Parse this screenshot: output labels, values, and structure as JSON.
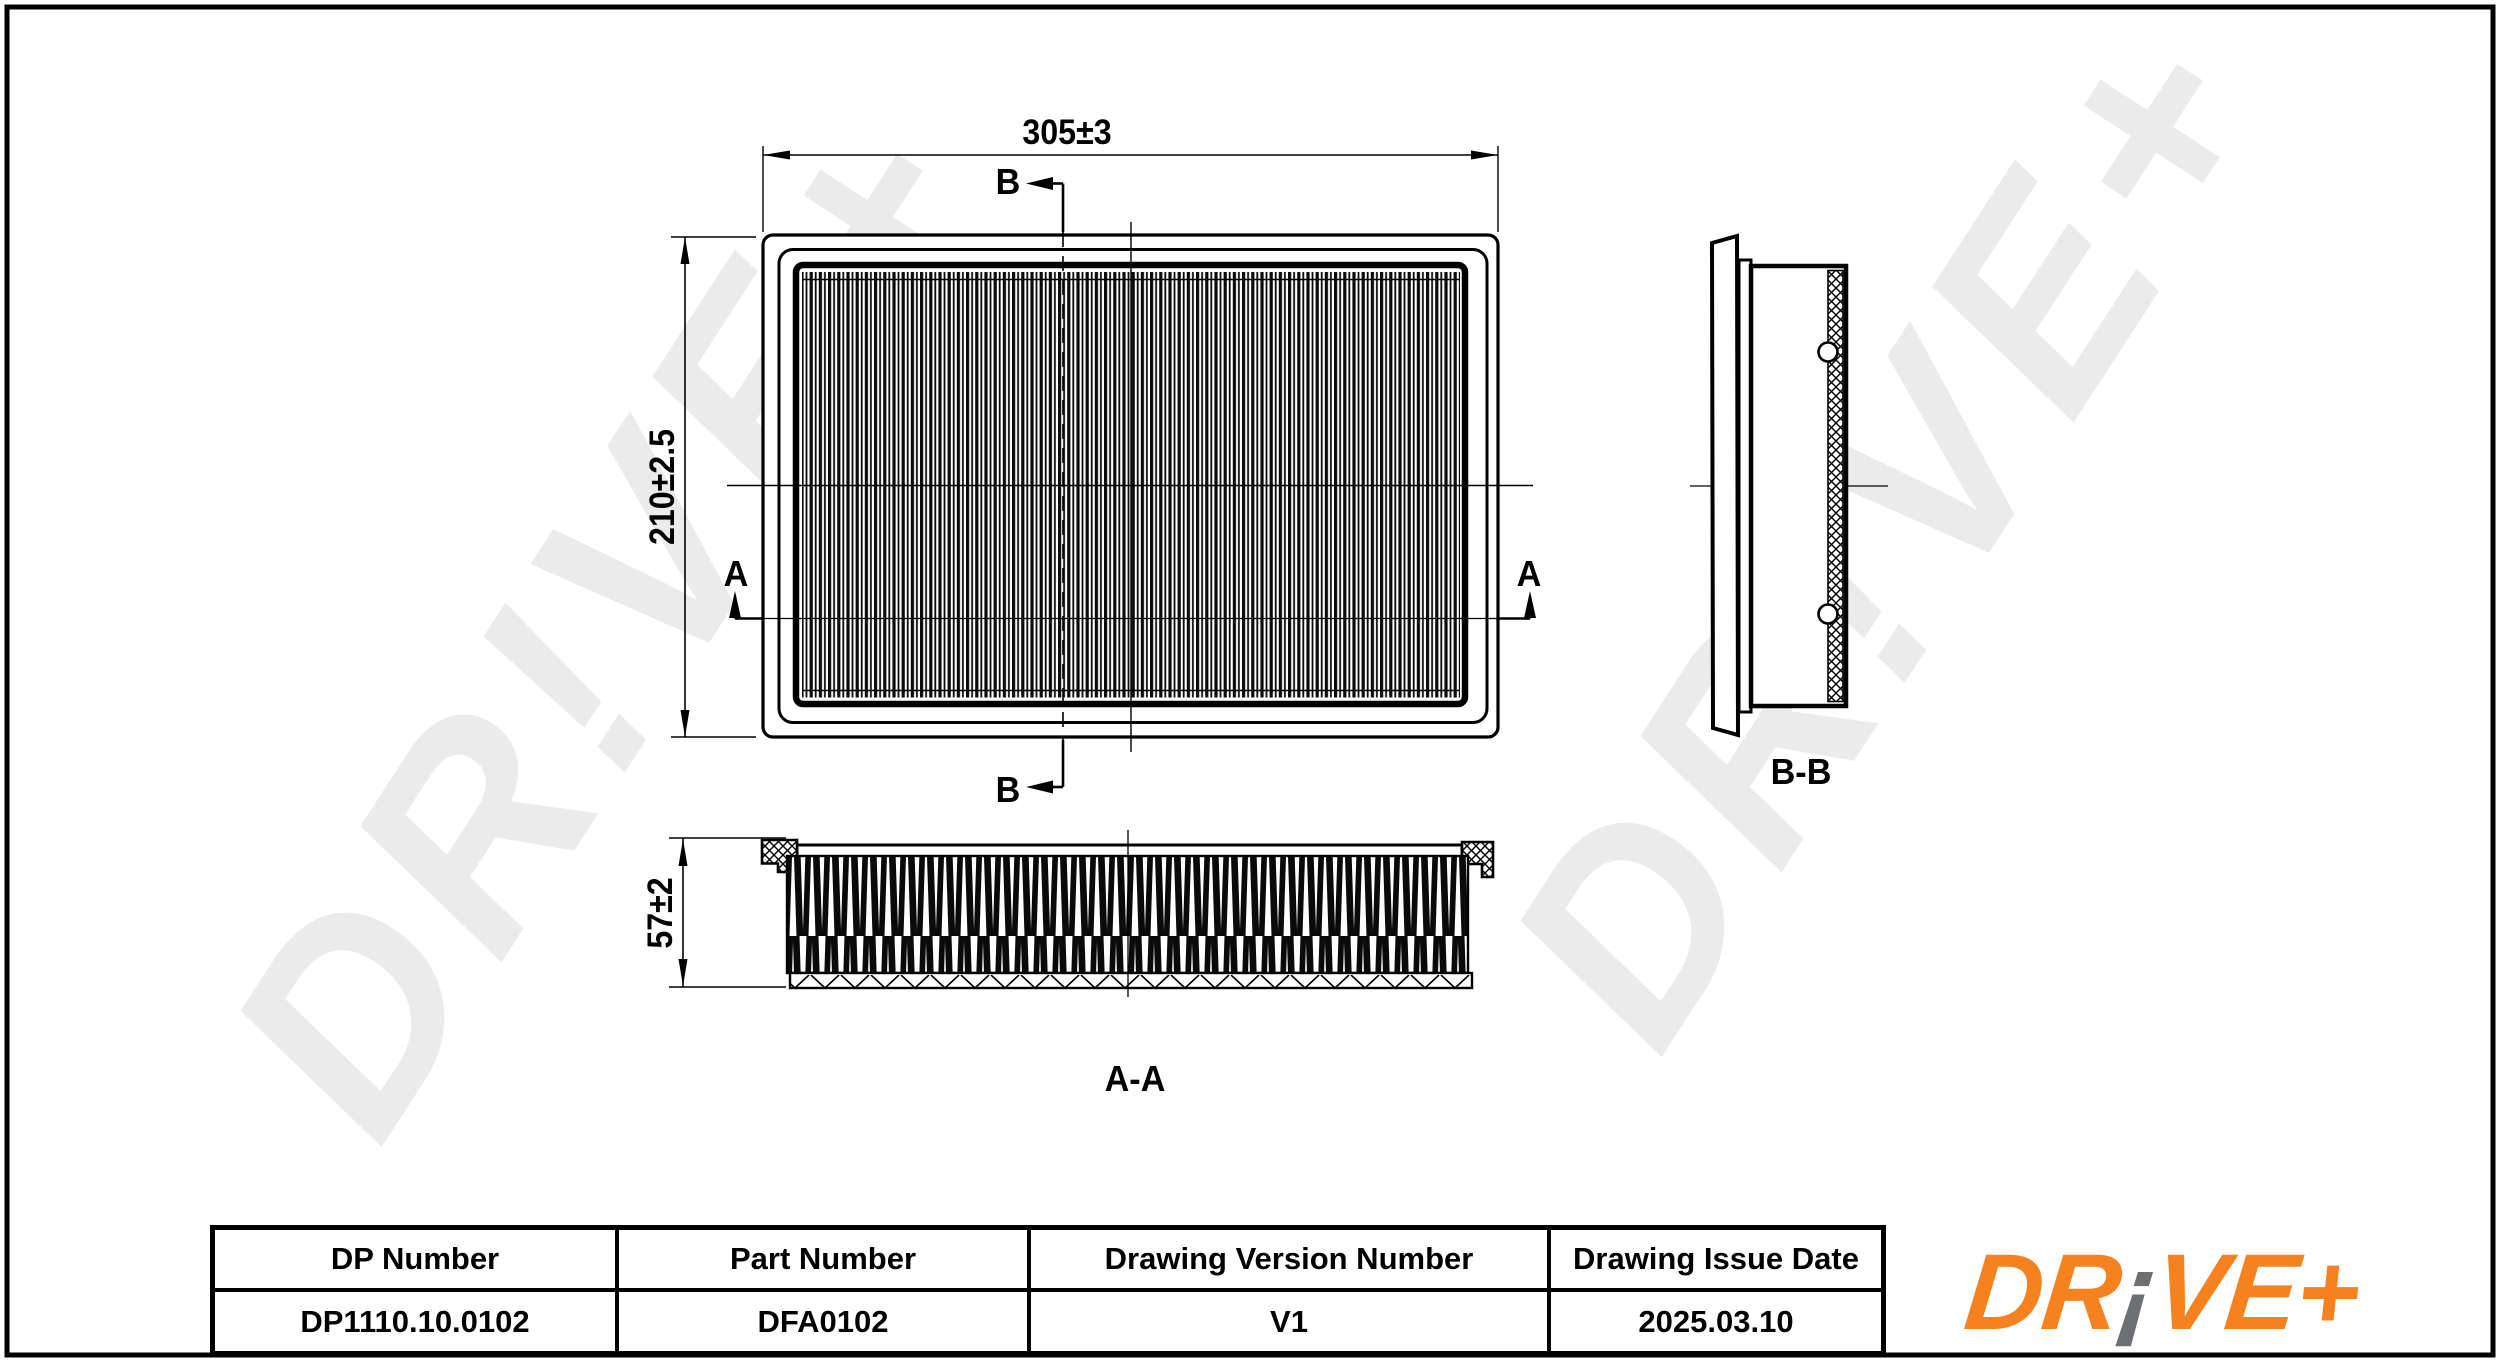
{
  "sheet": {
    "background": "#ffffff",
    "border_color": "#000000"
  },
  "watermark": {
    "text": "DR!VE+",
    "color": "#ebebeb"
  },
  "views": {
    "plan": {
      "width_dim": "305±3",
      "height_dim": "210±2.5",
      "section_a_label": "A",
      "section_b_label": "B"
    },
    "section_aa": {
      "label": "A-A",
      "depth_dim": "57±2"
    },
    "section_bb": {
      "label": "B-B"
    }
  },
  "title_block": {
    "columns": [
      {
        "header": "DP Number",
        "value": "DP1110.10.0102"
      },
      {
        "header": "Part Number",
        "value": "DFA0102"
      },
      {
        "header": "Drawing Version Number",
        "value": "V1"
      },
      {
        "header": "Drawing Issue Date",
        "value": "2025.03.10"
      }
    ]
  },
  "logo": {
    "prefix": "DR",
    "excl": "¡",
    "suffix": "VE",
    "plus": "+",
    "orange": "#F5821F",
    "gray": "#6E6F72"
  }
}
